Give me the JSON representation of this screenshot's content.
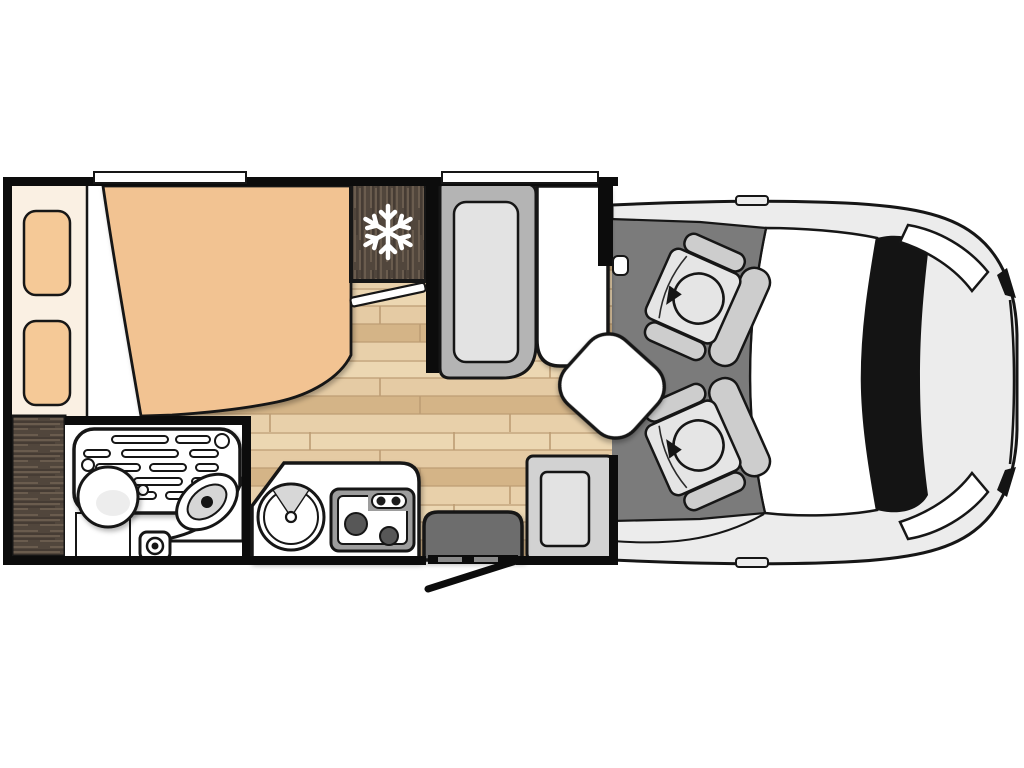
{
  "diagram": {
    "type": "floorplan",
    "description": "Top-view floor plan of a motorhome with rear bed, bathroom, kitchen, dinette, entry door and driver cab with two swivel seats",
    "view": "top-down"
  },
  "colors": {
    "page_bg": "#ffffff",
    "outline": "#161616",
    "wall": "#0c0c0c",
    "white": "#ffffff",
    "wood_base": "#e5cba4",
    "wood_mid": "#ecd7b2",
    "wood_dark": "#d4b487",
    "wood_line": "#bd9d74",
    "dark_wood": "#51463c",
    "dark_wood_streak": "#6e6051",
    "dark_wood_deep": "#3a322b",
    "bed_spread": "#f2c392",
    "pillow": "#f5c997",
    "headboard": "#faf0e3",
    "cab_floor": "#7b7b7b",
    "vehicle_body": "#ececec",
    "trim_black": "#141414",
    "seat_frame": "#cdcdcd",
    "seat_cushion": "#e5e5e5",
    "bench_frame": "#b4b4b4",
    "bench_cushion": "#e3e3e3",
    "entry_bench_frame": "#d2d2d2",
    "table_white": "#ffffff",
    "step_gray": "#6d6d6d",
    "step_dash": "#8a8a8a",
    "stove_body": "#9d9d9d",
    "burner": "#575757",
    "knob": "#1c1c1c",
    "basin_shade": "#ededed",
    "toilet_inner": "#d6d6d6",
    "snowflake": "#ffffff"
  },
  "icons": {
    "fridge": "snowflake-icon",
    "seat_rotation": "rotate-arrow-icon"
  },
  "areas": {
    "bedroom": {
      "items": [
        "double-bed",
        "pillow-left",
        "pillow-right",
        "headboard-shelf",
        "sliding-door"
      ]
    },
    "storage": {
      "items": [
        "wardrobe"
      ]
    },
    "bathroom": {
      "items": [
        "shower-tray",
        "washbasin",
        "toilet",
        "floor-drain"
      ]
    },
    "kitchen": {
      "items": [
        "counter",
        "round-sink",
        "two-burner-stove"
      ]
    },
    "cooling": {
      "items": [
        "refrigerator"
      ]
    },
    "lounge": {
      "items": [
        "dinette-bench",
        "table",
        "swivel-side-table",
        "entry-bench"
      ]
    },
    "entrance": {
      "items": [
        "entry-step",
        "entry-door"
      ]
    },
    "cab": {
      "items": [
        "driver-swivel-seat",
        "passenger-swivel-seat",
        "windshield",
        "headlight-left",
        "headlight-right"
      ]
    }
  }
}
